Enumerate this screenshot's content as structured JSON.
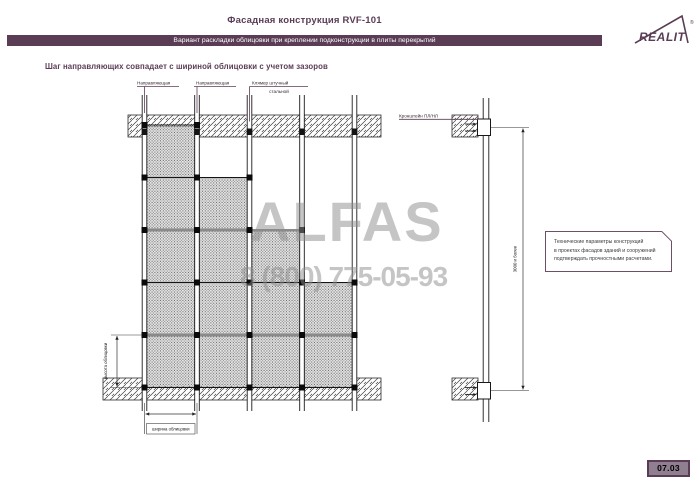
{
  "header": {
    "title": "Фасадная конструкция RVF-101",
    "subtitle": "Вариант раскладки облицовки при креплении подконструкции в плиты перекрытий",
    "logo_text": "REALIT",
    "logo_registered": "®"
  },
  "section_heading": "Шаг направляющих совпадает с шириной облицовки с учетом зазоров",
  "watermark": {
    "name": "ALFAS",
    "phone": "8 (800) 775-05-93"
  },
  "elevation": {
    "labels": {
      "rail_left": "Направляющая",
      "rail_right": "Направляющая",
      "clamp_line1": "Клямер штучный",
      "clamp_line2": "стальной"
    },
    "dimensions": {
      "height": "высота облицовки",
      "width": "ширина облицовки"
    },
    "grid": {
      "rails_x": [
        144.5,
        197,
        249.5,
        302,
        354.5
      ],
      "row_top": 125,
      "row_h": 52.5,
      "num_rows": 5,
      "column_start_rows": [
        0,
        1,
        2,
        3
      ]
    }
  },
  "section_view": {
    "bracket_label": "Кронштейн ПЛ/НЛ",
    "dimension": "3000 и более"
  },
  "note": {
    "lines": [
      "Технические параметры конструкций",
      "в проектах фасадов зданий и сооружений",
      "подтверждать прочностными расчетами."
    ]
  },
  "footer": {
    "page_number": "07.03"
  },
  "colors": {
    "brand": "#5a3c55",
    "line": "#1c1c1c",
    "watermark_gray": "#8c8c8c",
    "badge_fill": "#907f90"
  }
}
